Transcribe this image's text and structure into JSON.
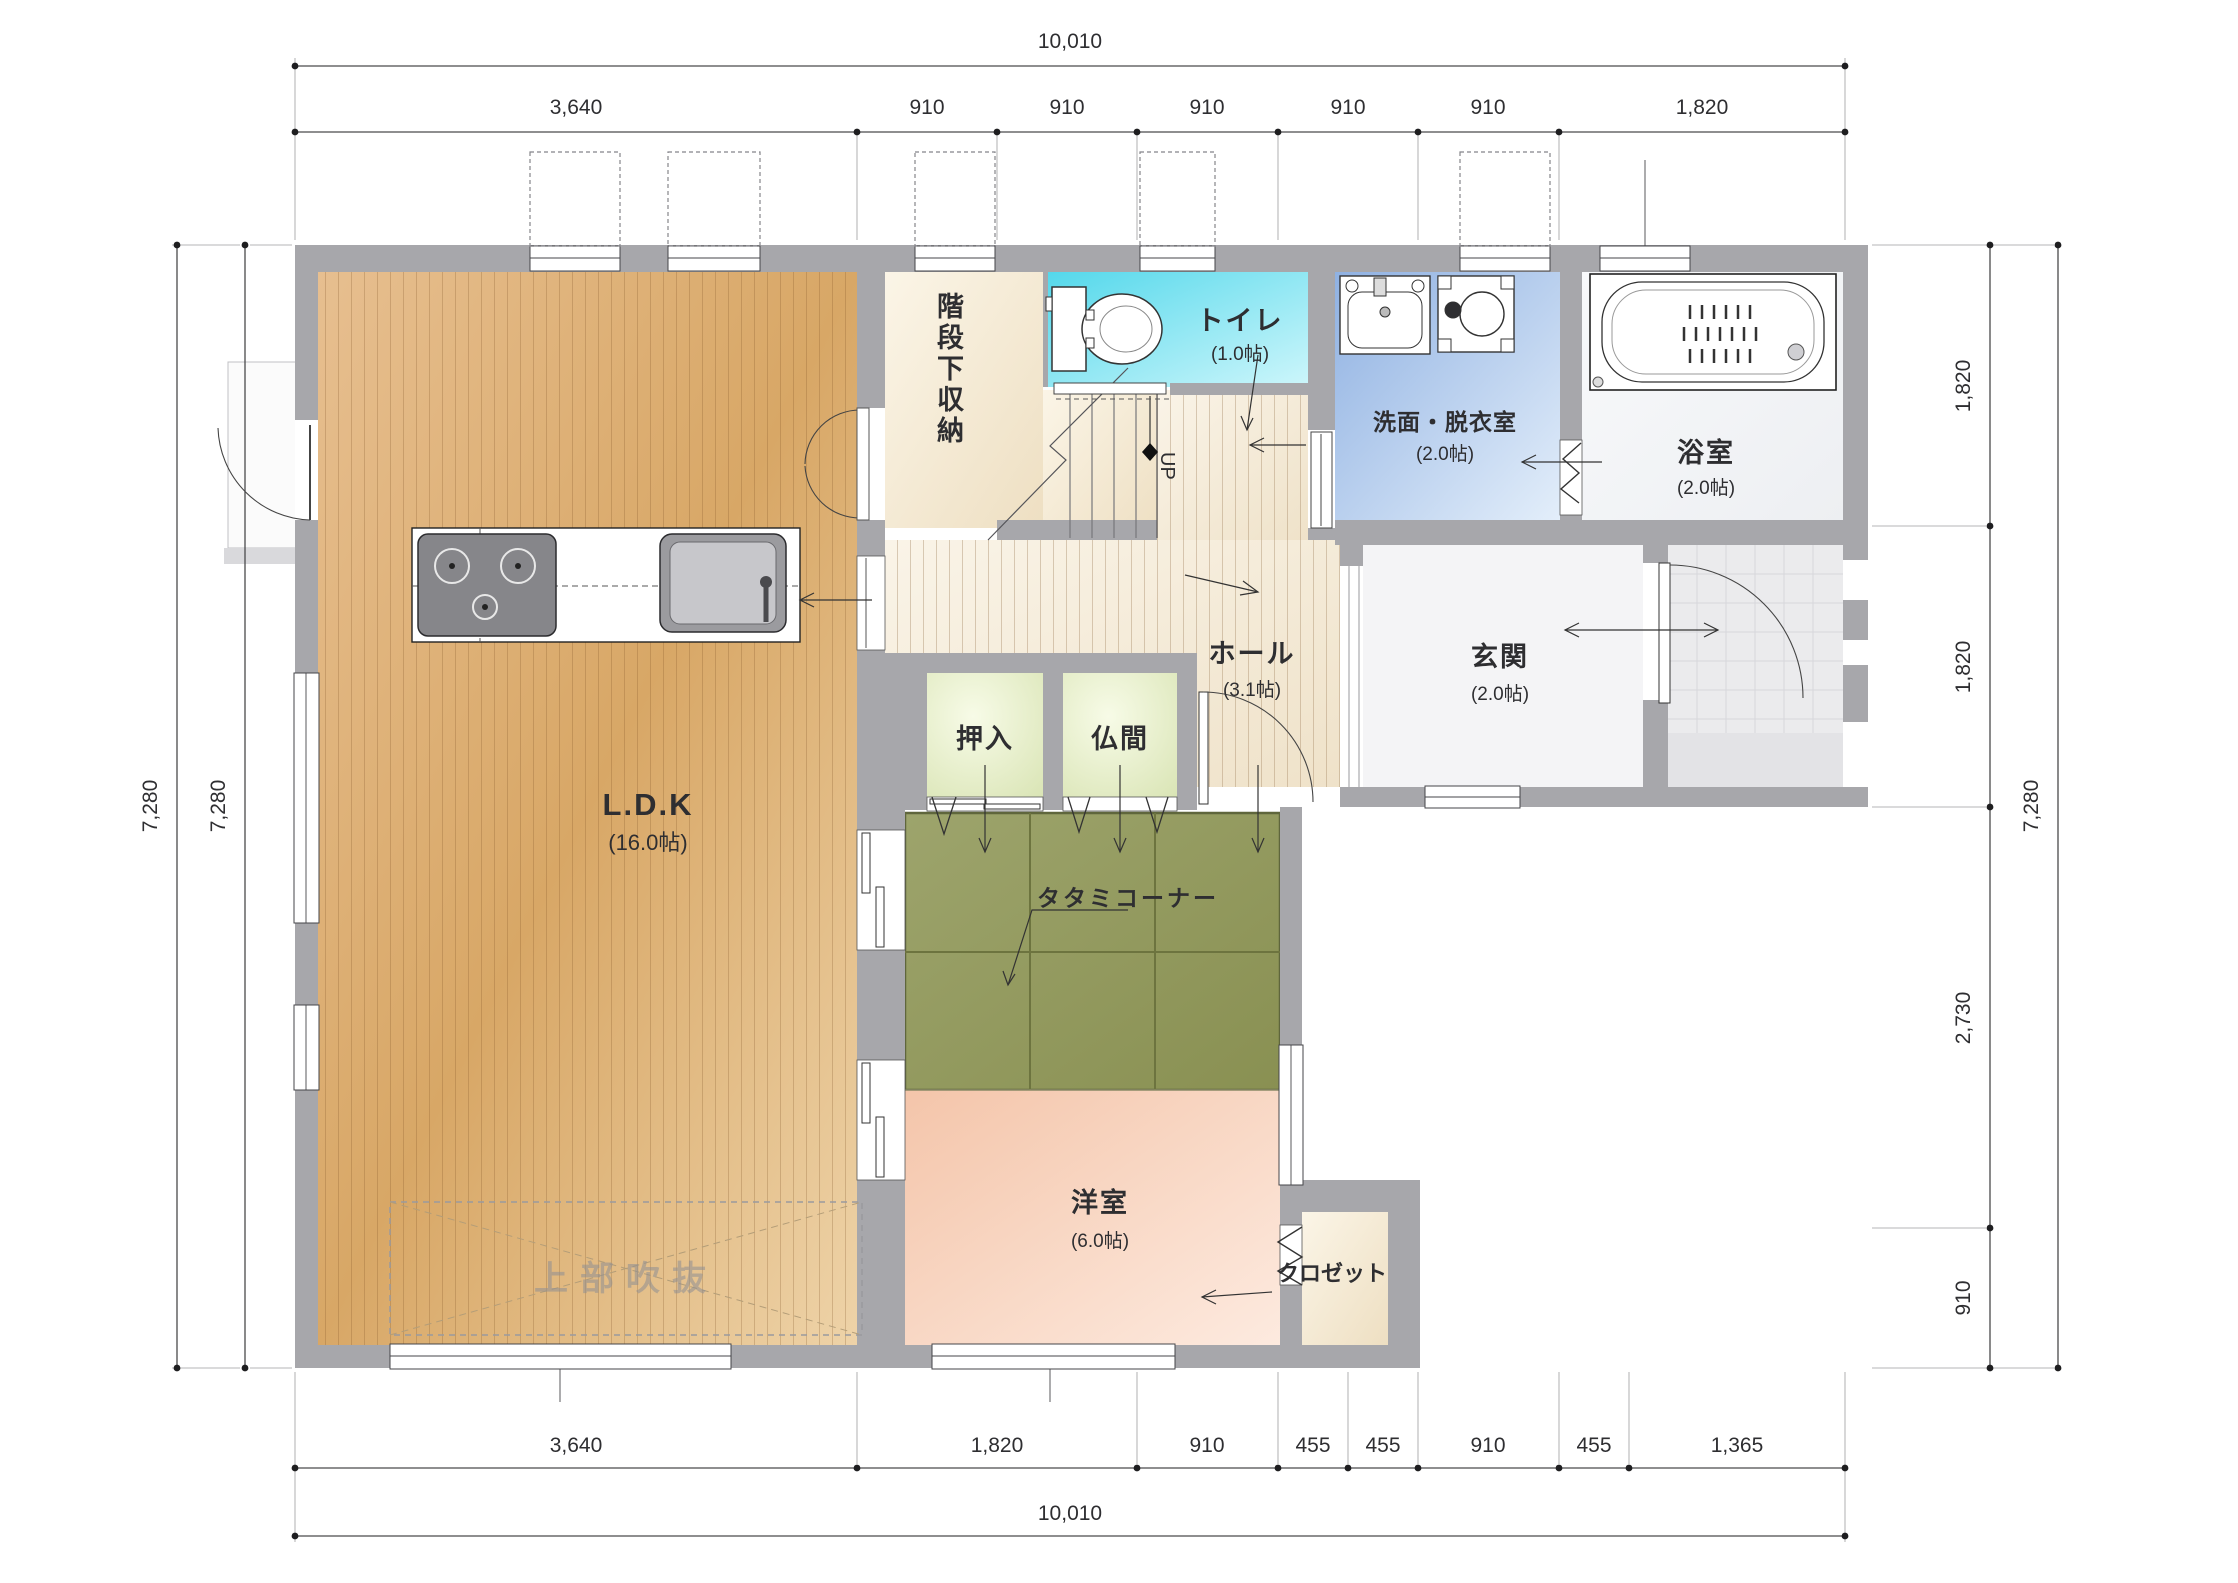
{
  "title": "1F floor plan (間取り図)",
  "rooms": {
    "ldk": {
      "name": "L.D.K",
      "size": "(16.0帖)"
    },
    "stair_storage": {
      "name": "階段下収納"
    },
    "toilet": {
      "name": "トイレ",
      "size": "(1.0帖)"
    },
    "washroom": {
      "name": "洗面・脱衣室",
      "size": "(2.0帖)"
    },
    "bath": {
      "name": "浴室",
      "size": "(2.0帖)"
    },
    "hall": {
      "name": "ホール",
      "size": "(3.1帖)"
    },
    "entrance": {
      "name": "玄関",
      "size": "(2.0帖)"
    },
    "oshiire": {
      "name": "押入"
    },
    "butsuma": {
      "name": "仏間"
    },
    "tatami": {
      "name": "タタミコーナー"
    },
    "western": {
      "name": "洋室",
      "size": "(6.0帖)"
    },
    "closet": {
      "name": "クロゼット"
    }
  },
  "annotations": {
    "up": "UP",
    "upper_area": "上部吹抜"
  },
  "dimensions": {
    "top_total": "10,010",
    "top_segments": [
      "3,640",
      "910",
      "910",
      "910",
      "910",
      "910",
      "1,820"
    ],
    "bottom_segments": [
      "3,640",
      "1,820",
      "910",
      "455",
      "455",
      "910",
      "455",
      "1,365"
    ],
    "bottom_total": "10,010",
    "left_total_outer": "7,280",
    "left_total_inner": "7,280",
    "right_segments": [
      "1,820",
      "1,820",
      "2,730",
      "910"
    ],
    "right_total": "7,280"
  },
  "colors": {
    "wall": "#a7a7ab",
    "wood_floor": "#dcab6d",
    "hall_floor": "#f3e7d0",
    "toilet": "#5ad9ec",
    "washroom": "#93b4e3",
    "western_room": "#f5c9af",
    "tatami": "#93994f",
    "closet_green": "#e4edc4",
    "dimension_text": "#2e2e30"
  }
}
